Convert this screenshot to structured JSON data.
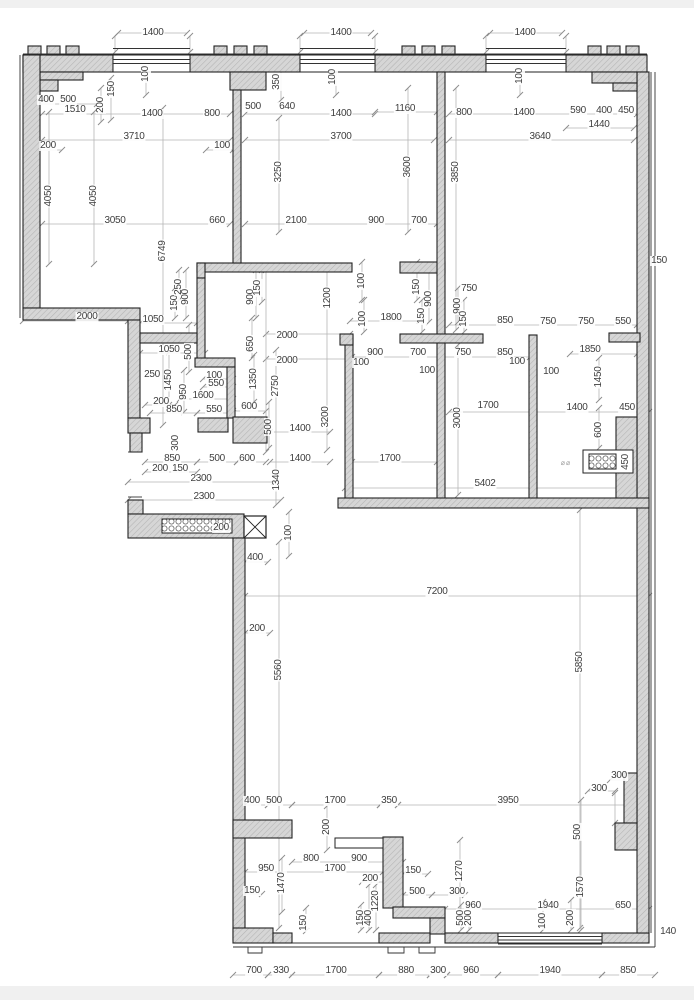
{
  "document": {
    "type": "architectural-floor-plan",
    "units": "mm",
    "description": "CAD dimensioned apartment floor plan with hatched walls, windows and dimension chains"
  },
  "colors": {
    "background": "#ffffff",
    "margin_strip": "#f0f0f0",
    "wall_fill": "#d6d6d6",
    "wall_hatch": "#b3b3b3",
    "wall_stroke": "#222222",
    "dim_line": "#b5b5b5",
    "dim_text": "#3f3f3f"
  },
  "symbols": [
    {
      "name": "shaft-x-box",
      "x": 255,
      "y": 527
    },
    {
      "name": "vent-grille-horizontal",
      "x": 197,
      "y": 526
    },
    {
      "name": "vent-grille-right-wall",
      "x": 602,
      "y": 461
    }
  ],
  "annotation_marks": [
    {
      "t": "⌀⌀",
      "x": 566,
      "y": 463
    }
  ],
  "dim_labels": [
    {
      "t": "1400",
      "x": 153,
      "y": 33
    },
    {
      "t": "1400",
      "x": 341,
      "y": 33
    },
    {
      "t": "1400",
      "x": 525,
      "y": 33
    },
    {
      "t": "400",
      "x": 46,
      "y": 100
    },
    {
      "t": "500",
      "x": 68,
      "y": 100
    },
    {
      "t": "1510",
      "x": 75,
      "y": 110
    },
    {
      "t": "200",
      "x": 101,
      "y": 105,
      "r": 1
    },
    {
      "t": "150",
      "x": 112,
      "y": 89,
      "r": 1
    },
    {
      "t": "100",
      "x": 146,
      "y": 74,
      "r": 1
    },
    {
      "t": "1400",
      "x": 152,
      "y": 114
    },
    {
      "t": "800",
      "x": 212,
      "y": 114
    },
    {
      "t": "3710",
      "x": 134,
      "y": 137
    },
    {
      "t": "200",
      "x": 48,
      "y": 146
    },
    {
      "t": "100",
      "x": 222,
      "y": 146
    },
    {
      "t": "4050",
      "x": 49,
      "y": 196,
      "r": 1
    },
    {
      "t": "4050",
      "x": 94,
      "y": 196,
      "r": 1
    },
    {
      "t": "3050",
      "x": 115,
      "y": 221
    },
    {
      "t": "660",
      "x": 217,
      "y": 221
    },
    {
      "t": "6749",
      "x": 163,
      "y": 251,
      "r": 1
    },
    {
      "t": "500",
      "x": 253,
      "y": 107
    },
    {
      "t": "640",
      "x": 287,
      "y": 107
    },
    {
      "t": "350",
      "x": 277,
      "y": 82,
      "r": 1
    },
    {
      "t": "100",
      "x": 333,
      "y": 77,
      "r": 1
    },
    {
      "t": "1400",
      "x": 341,
      "y": 114
    },
    {
      "t": "1160",
      "x": 405,
      "y": 109
    },
    {
      "t": "3700",
      "x": 341,
      "y": 137
    },
    {
      "t": "3250",
      "x": 279,
      "y": 172,
      "r": 1
    },
    {
      "t": "3600",
      "x": 408,
      "y": 167,
      "r": 1
    },
    {
      "t": "2100",
      "x": 296,
      "y": 221
    },
    {
      "t": "900",
      "x": 376,
      "y": 221
    },
    {
      "t": "700",
      "x": 419,
      "y": 221
    },
    {
      "t": "800",
      "x": 464,
      "y": 113
    },
    {
      "t": "1400",
      "x": 524,
      "y": 113
    },
    {
      "t": "590",
      "x": 578,
      "y": 111
    },
    {
      "t": "400",
      "x": 604,
      "y": 111
    },
    {
      "t": "450",
      "x": 626,
      "y": 111
    },
    {
      "t": "1440",
      "x": 599,
      "y": 125
    },
    {
      "t": "3640",
      "x": 540,
      "y": 137
    },
    {
      "t": "100",
      "x": 520,
      "y": 76,
      "r": 1
    },
    {
      "t": "3850",
      "x": 456,
      "y": 172,
      "r": 1
    },
    {
      "t": "150",
      "x": 659,
      "y": 261
    },
    {
      "t": "2000",
      "x": 87,
      "y": 317
    },
    {
      "t": "1050",
      "x": 153,
      "y": 320
    },
    {
      "t": "150",
      "x": 175,
      "y": 303,
      "r": 1
    },
    {
      "t": "250",
      "x": 179,
      "y": 287,
      "r": 1
    },
    {
      "t": "900",
      "x": 186,
      "y": 297,
      "r": 1
    },
    {
      "t": "900",
      "x": 251,
      "y": 297,
      "r": 1
    },
    {
      "t": "150",
      "x": 258,
      "y": 288,
      "r": 1
    },
    {
      "t": "1200",
      "x": 328,
      "y": 298,
      "r": 1
    },
    {
      "t": "1050",
      "x": 169,
      "y": 350
    },
    {
      "t": "500",
      "x": 189,
      "y": 352,
      "r": 1
    },
    {
      "t": "650",
      "x": 251,
      "y": 344,
      "r": 1
    },
    {
      "t": "2000",
      "x": 287,
      "y": 336
    },
    {
      "t": "2000",
      "x": 287,
      "y": 361
    },
    {
      "t": "250",
      "x": 152,
      "y": 375
    },
    {
      "t": "1450",
      "x": 169,
      "y": 380,
      "r": 1
    },
    {
      "t": "100",
      "x": 214,
      "y": 376
    },
    {
      "t": "550",
      "x": 216,
      "y": 384
    },
    {
      "t": "950",
      "x": 184,
      "y": 392,
      "r": 1
    },
    {
      "t": "1600",
      "x": 203,
      "y": 396
    },
    {
      "t": "1350",
      "x": 254,
      "y": 379,
      "r": 1
    },
    {
      "t": "2750",
      "x": 276,
      "y": 386,
      "r": 1
    },
    {
      "t": "200",
      "x": 161,
      "y": 402
    },
    {
      "t": "850",
      "x": 174,
      "y": 410
    },
    {
      "t": "550",
      "x": 214,
      "y": 410
    },
    {
      "t": "600",
      "x": 249,
      "y": 407
    },
    {
      "t": "500",
      "x": 269,
      "y": 427,
      "r": 1
    },
    {
      "t": "1400",
      "x": 300,
      "y": 429
    },
    {
      "t": "3200",
      "x": 326,
      "y": 417,
      "r": 1
    },
    {
      "t": "300",
      "x": 176,
      "y": 443,
      "r": 1
    },
    {
      "t": "850",
      "x": 172,
      "y": 459
    },
    {
      "t": "500",
      "x": 217,
      "y": 459
    },
    {
      "t": "600",
      "x": 247,
      "y": 459
    },
    {
      "t": "1400",
      "x": 300,
      "y": 459
    },
    {
      "t": "200",
      "x": 160,
      "y": 469
    },
    {
      "t": "150",
      "x": 180,
      "y": 469
    },
    {
      "t": "2300",
      "x": 201,
      "y": 479
    },
    {
      "t": "1340",
      "x": 277,
      "y": 480,
      "r": 1
    },
    {
      "t": "2300",
      "x": 204,
      "y": 497
    },
    {
      "t": "100",
      "x": 362,
      "y": 281,
      "r": 1
    },
    {
      "t": "100",
      "x": 363,
      "y": 319,
      "r": 1
    },
    {
      "t": "1800",
      "x": 391,
      "y": 318
    },
    {
      "t": "150",
      "x": 417,
      "y": 287,
      "r": 1
    },
    {
      "t": "900",
      "x": 429,
      "y": 299,
      "r": 1
    },
    {
      "t": "150",
      "x": 422,
      "y": 316,
      "r": 1
    },
    {
      "t": "900",
      "x": 458,
      "y": 306,
      "r": 1
    },
    {
      "t": "150",
      "x": 464,
      "y": 319,
      "r": 1
    },
    {
      "t": "750",
      "x": 469,
      "y": 289
    },
    {
      "t": "850",
      "x": 505,
      "y": 321
    },
    {
      "t": "750",
      "x": 548,
      "y": 322
    },
    {
      "t": "750",
      "x": 586,
      "y": 322
    },
    {
      "t": "550",
      "x": 623,
      "y": 322
    },
    {
      "t": "900",
      "x": 375,
      "y": 353
    },
    {
      "t": "700",
      "x": 418,
      "y": 353
    },
    {
      "t": "750",
      "x": 463,
      "y": 353
    },
    {
      "t": "850",
      "x": 505,
      "y": 353
    },
    {
      "t": "100",
      "x": 361,
      "y": 363
    },
    {
      "t": "100",
      "x": 517,
      "y": 362
    },
    {
      "t": "100",
      "x": 427,
      "y": 371
    },
    {
      "t": "100",
      "x": 551,
      "y": 372
    },
    {
      "t": "1850",
      "x": 590,
      "y": 350
    },
    {
      "t": "1450",
      "x": 599,
      "y": 377,
      "r": 1
    },
    {
      "t": "1700",
      "x": 488,
      "y": 406
    },
    {
      "t": "1400",
      "x": 577,
      "y": 408
    },
    {
      "t": "450",
      "x": 627,
      "y": 408
    },
    {
      "t": "3000",
      "x": 458,
      "y": 418,
      "r": 1
    },
    {
      "t": "600",
      "x": 599,
      "y": 430,
      "r": 1
    },
    {
      "t": "1700",
      "x": 390,
      "y": 459
    },
    {
      "t": "450",
      "x": 626,
      "y": 462,
      "r": 1
    },
    {
      "t": "5402",
      "x": 485,
      "y": 484
    },
    {
      "t": "200",
      "x": 221,
      "y": 528
    },
    {
      "t": "100",
      "x": 289,
      "y": 533,
      "r": 1
    },
    {
      "t": "400",
      "x": 255,
      "y": 558
    },
    {
      "t": "200",
      "x": 257,
      "y": 629
    },
    {
      "t": "5560",
      "x": 279,
      "y": 670,
      "r": 1
    },
    {
      "t": "7200",
      "x": 437,
      "y": 592
    },
    {
      "t": "5850",
      "x": 580,
      "y": 662,
      "r": 1
    },
    {
      "t": "300",
      "x": 619,
      "y": 776
    },
    {
      "t": "300",
      "x": 599,
      "y": 789
    },
    {
      "t": "400",
      "x": 252,
      "y": 801
    },
    {
      "t": "500",
      "x": 274,
      "y": 801
    },
    {
      "t": "1700",
      "x": 335,
      "y": 801
    },
    {
      "t": "350",
      "x": 389,
      "y": 801
    },
    {
      "t": "3950",
      "x": 508,
      "y": 801
    },
    {
      "t": "200",
      "x": 327,
      "y": 827,
      "r": 1
    },
    {
      "t": "800",
      "x": 311,
      "y": 859
    },
    {
      "t": "900",
      "x": 359,
      "y": 859
    },
    {
      "t": "950",
      "x": 266,
      "y": 869
    },
    {
      "t": "1700",
      "x": 335,
      "y": 869
    },
    {
      "t": "150",
      "x": 252,
      "y": 891
    },
    {
      "t": "1470",
      "x": 282,
      "y": 883,
      "r": 1
    },
    {
      "t": "200",
      "x": 370,
      "y": 879
    },
    {
      "t": "150",
      "x": 413,
      "y": 871
    },
    {
      "t": "1270",
      "x": 460,
      "y": 871,
      "r": 1
    },
    {
      "t": "500",
      "x": 417,
      "y": 892
    },
    {
      "t": "300",
      "x": 457,
      "y": 892
    },
    {
      "t": "150",
      "x": 361,
      "y": 918,
      "r": 1
    },
    {
      "t": "400",
      "x": 369,
      "y": 918,
      "r": 1
    },
    {
      "t": "1220",
      "x": 376,
      "y": 901,
      "r": 1
    },
    {
      "t": "150",
      "x": 304,
      "y": 923,
      "r": 1
    },
    {
      "t": "960",
      "x": 473,
      "y": 906
    },
    {
      "t": "1940",
      "x": 548,
      "y": 906
    },
    {
      "t": "650",
      "x": 623,
      "y": 906
    },
    {
      "t": "500",
      "x": 578,
      "y": 832,
      "r": 1
    },
    {
      "t": "1570",
      "x": 581,
      "y": 887,
      "r": 1
    },
    {
      "t": "500",
      "x": 461,
      "y": 918,
      "r": 1
    },
    {
      "t": "200",
      "x": 469,
      "y": 918,
      "r": 1
    },
    {
      "t": "100",
      "x": 543,
      "y": 921,
      "r": 1
    },
    {
      "t": "200",
      "x": 571,
      "y": 918,
      "r": 1
    },
    {
      "t": "140",
      "x": 668,
      "y": 932
    },
    {
      "t": "700",
      "x": 254,
      "y": 971
    },
    {
      "t": "330",
      "x": 281,
      "y": 971
    },
    {
      "t": "1700",
      "x": 336,
      "y": 971
    },
    {
      "t": "880",
      "x": 406,
      "y": 971
    },
    {
      "t": "300",
      "x": 438,
      "y": 971
    },
    {
      "t": "960",
      "x": 471,
      "y": 971
    },
    {
      "t": "1940",
      "x": 550,
      "y": 971
    },
    {
      "t": "850",
      "x": 628,
      "y": 971
    }
  ]
}
